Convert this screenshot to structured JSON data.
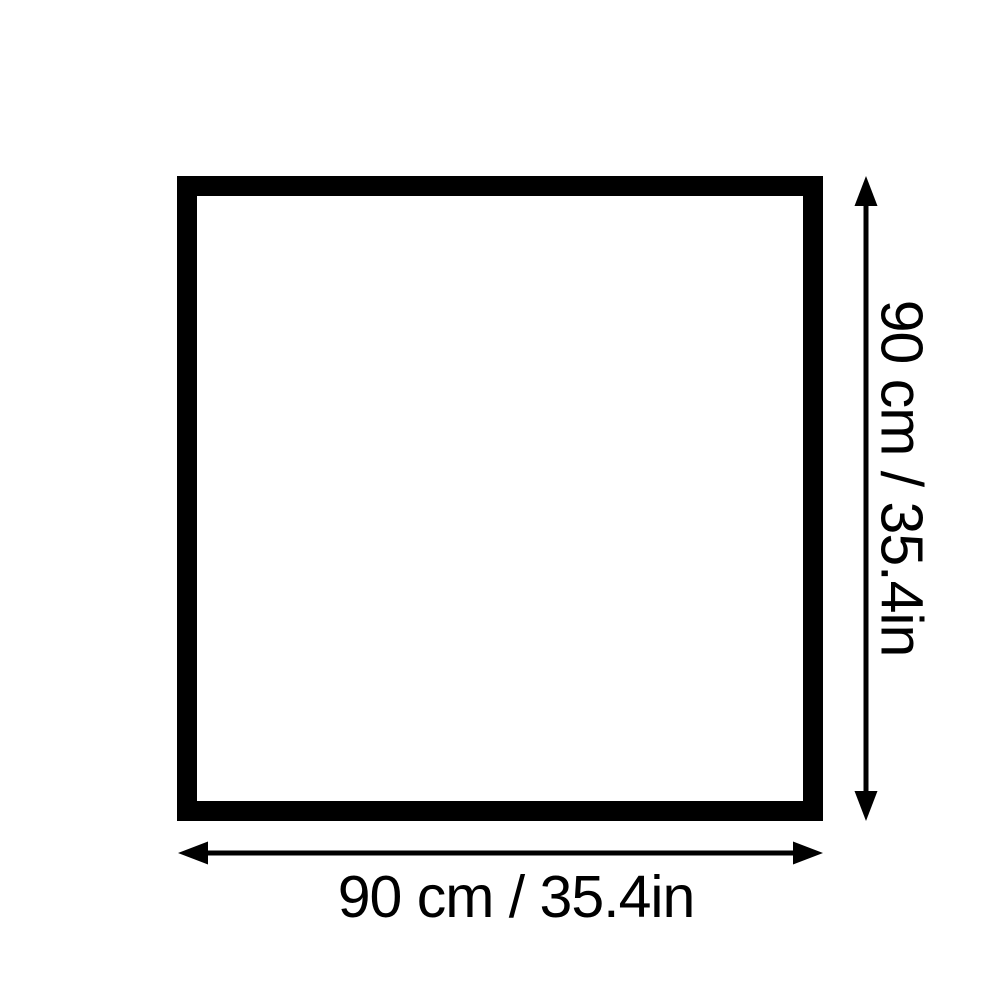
{
  "diagram": {
    "background_color": "#ffffff",
    "line_color": "#000000",
    "box": {
      "description": "square product outline",
      "border_color": "#000000"
    },
    "icons": {
      "height_arrow_icon": "double-headed-vertical-arrow",
      "width_arrow_icon": "double-headed-horizontal-arrow"
    },
    "dimensions": {
      "width_label": "90 cm / 35.4in",
      "height_label": "90 cm / 35.4in",
      "width_cm": 90,
      "width_in": 35.4,
      "height_cm": 90,
      "height_in": 35.4
    }
  }
}
